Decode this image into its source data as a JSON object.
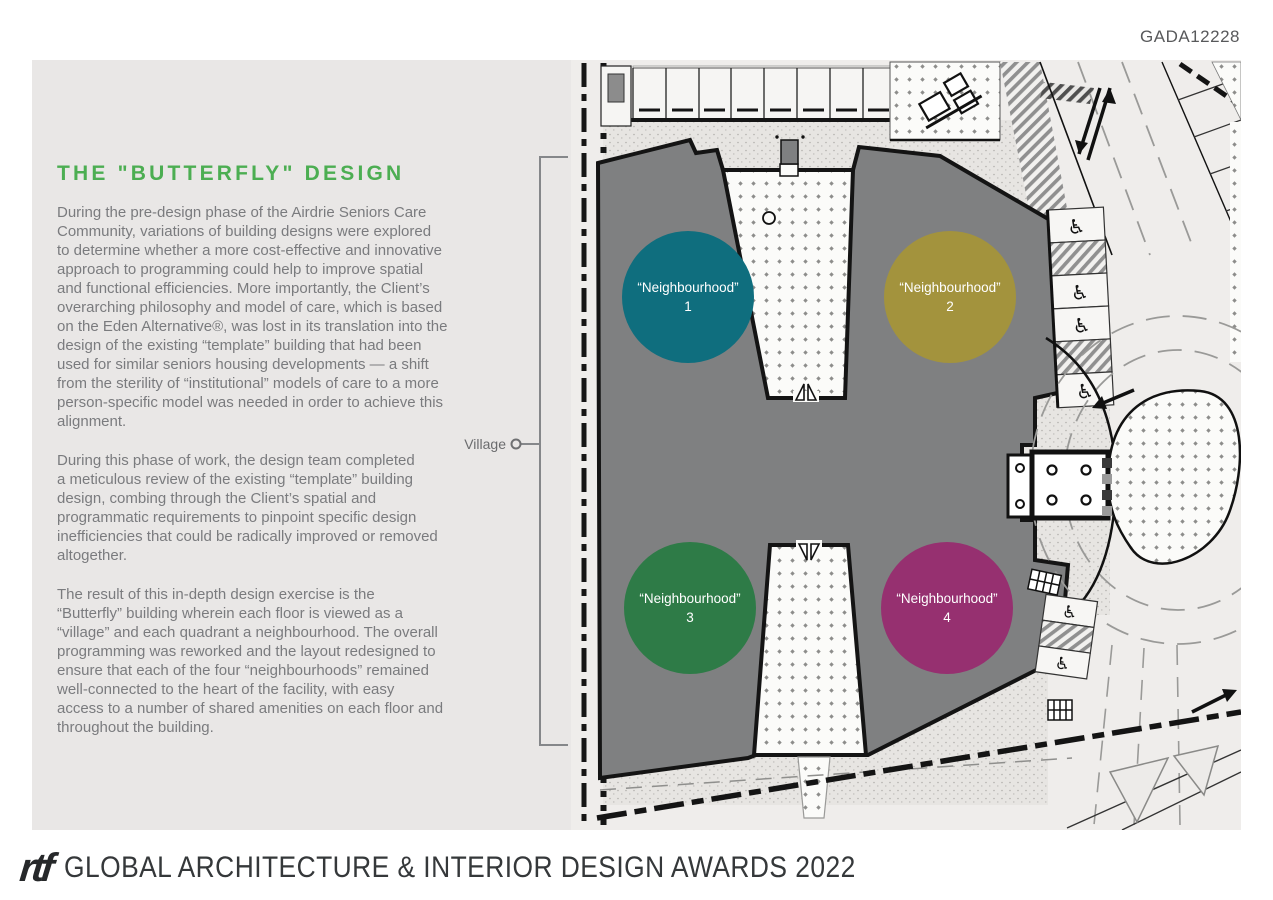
{
  "page": {
    "code": "GADA12228",
    "footer": {
      "logo": "rtf",
      "title": "GLOBAL ARCHITECTURE & INTERIOR DESIGN AWARDS 2022"
    }
  },
  "article": {
    "heading": "THE \"BUTTERFLY\" DESIGN",
    "paragraphs": [
      "During the pre-design phase of the Airdrie Seniors Care\nCommunity, variations of building designs were explored\nto determine whether a more cost-effective and innovative\napproach to programming could help to improve spatial\nand functional efficiencies. More importantly, the Client’s\noverarching philosophy and model of care, which is based\non the Eden Alternative®, was lost in its translation into the\ndesign of the existing “template” building that had been\nused for similar seniors housing developments — a shift\nfrom the sterility of “institutional” models of care to a more\nperson-specific model was needed in order to achieve this\nalignment.",
      "During this phase of work, the design team completed\na meticulous review of the existing “template” building\ndesign, combing through the Client’s spatial and\nprogrammatic requirements to pinpoint specific design\ninefficiencies that could be radically improved or removed\naltogether.",
      "The result of this in-depth design exercise is the\n“Butterfly” building wherein each floor is viewed as a\n“village” and each quadrant a neighbourhood. The overall\nprogramming was reworked and the layout redesigned to\nensure that each of the four “neighbourhoods” remained\nwell-connected to the heart of the facility, with easy\naccess to a number of shared amenities on each floor and\nthroughout the building."
    ]
  },
  "plan": {
    "annotation": {
      "label": "Village"
    },
    "neighbourhoods": [
      {
        "label": "“Neighbourhood”",
        "number": "1",
        "color": "#0f6e7e"
      },
      {
        "label": "“Neighbourhood”",
        "number": "2",
        "color": "#a3933d"
      },
      {
        "label": "“Neighbourhood”",
        "number": "3",
        "color": "#2e7b47"
      },
      {
        "label": "“Neighbourhood”",
        "number": "4",
        "color": "#963070"
      }
    ],
    "colors": {
      "building": "#7f8081",
      "panel_background": "#e9e7e6",
      "heading_green": "#4cae52",
      "body_text": "#7a7b7e"
    }
  }
}
